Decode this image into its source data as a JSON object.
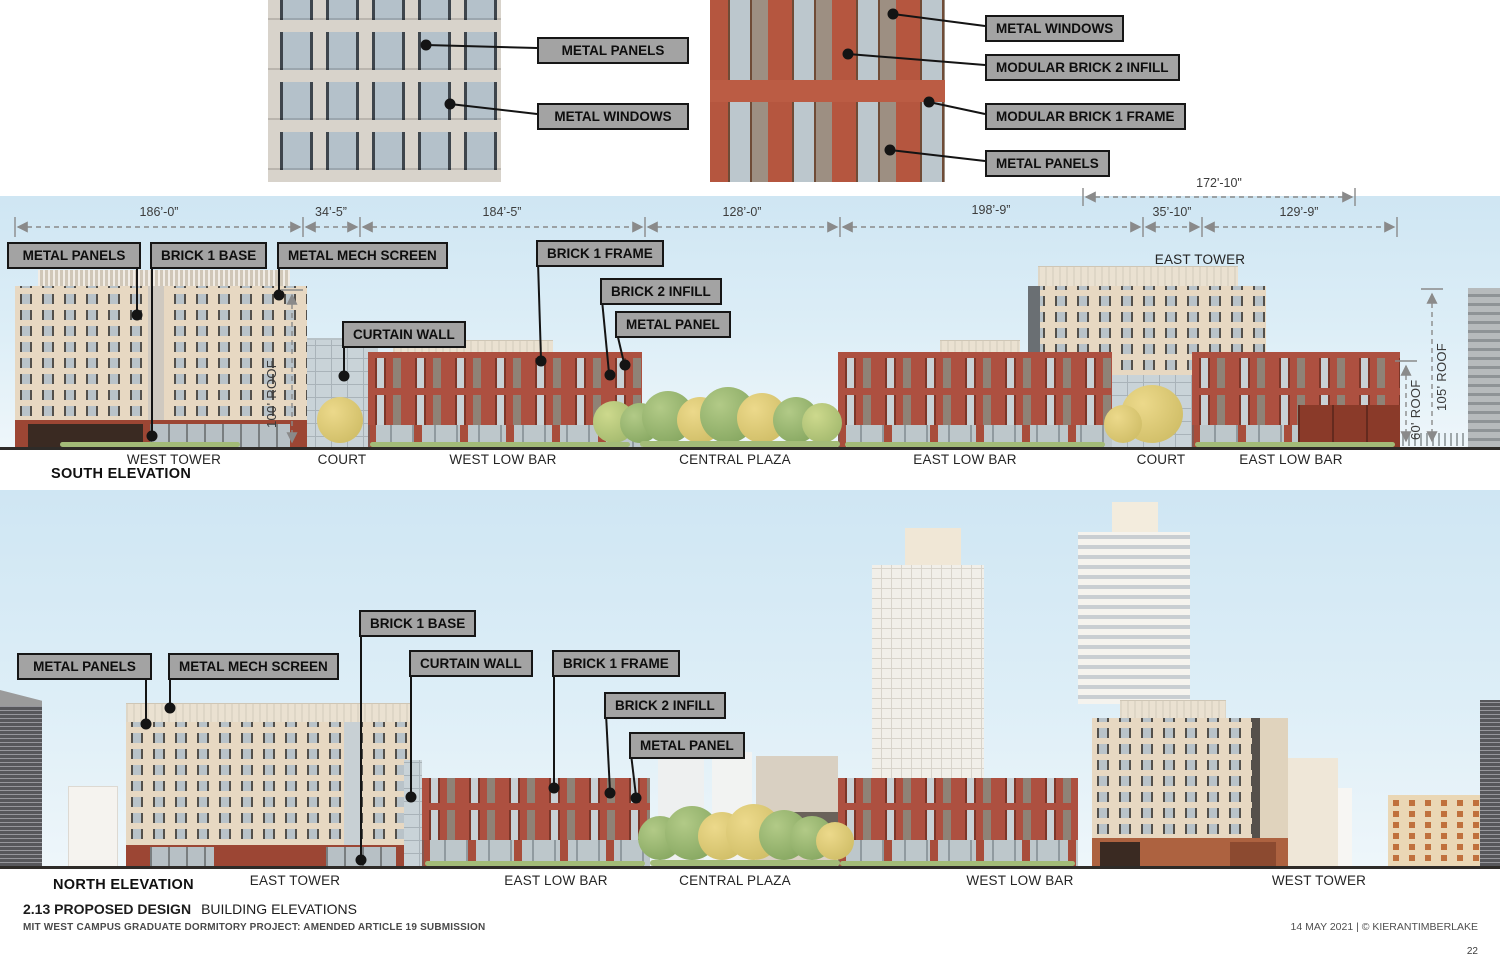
{
  "page": {
    "section_number_title": "2.13 PROPOSED DESIGN",
    "page_title": "BUILDING ELEVATIONS",
    "project_line": "MIT WEST CAMPUS GRADUATE DORMITORY PROJECT: AMENDED ARTICLE 19 SUBMISSION",
    "date_credit": "14 MAY 2021 | © KIERANTIMBERLAKE",
    "page_number": "22"
  },
  "detail_left": {
    "callouts": [
      "METAL PANELS",
      "METAL WINDOWS"
    ]
  },
  "detail_right": {
    "callouts": [
      "METAL WINDOWS",
      "MODULAR BRICK 2 INFILL",
      "MODULAR BRICK 1 FRAME",
      "METAL PANELS"
    ]
  },
  "south_elevation": {
    "title": "SOUTH ELEVATION",
    "overall_dimension": "172'-10\"",
    "dimensions": [
      "186’-0”",
      "34’-5”",
      "184’-5”",
      "128’-0”",
      "198’-9”",
      "35’-10”",
      "129’-9”"
    ],
    "callouts": [
      "METAL PANELS",
      "BRICK 1 BASE",
      "METAL MECH SCREEN",
      "CURTAIN WALL",
      "BRICK 1 FRAME",
      "BRICK 2 INFILL",
      "METAL PANEL"
    ],
    "building_label": "EAST TOWER",
    "roof_dims": [
      "100' ROOF",
      "60' ROOF",
      "105' ROOF"
    ],
    "section_labels": [
      "WEST TOWER",
      "COURT",
      "WEST LOW BAR",
      "CENTRAL PLAZA",
      "EAST LOW BAR",
      "COURT",
      "EAST LOW BAR"
    ]
  },
  "north_elevation": {
    "title": "NORTH ELEVATION",
    "callouts": [
      "METAL PANELS",
      "METAL MECH SCREEN",
      "BRICK 1 BASE",
      "CURTAIN WALL",
      "BRICK 1 FRAME",
      "BRICK 2 INFILL",
      "METAL PANEL"
    ],
    "section_labels": [
      "EAST TOWER",
      "EAST LOW BAR",
      "CENTRAL PLAZA",
      "WEST LOW BAR",
      "WEST TOWER"
    ]
  },
  "colors": {
    "sky_top": "#cfe6f3",
    "sky_bottom": "#eef6fa",
    "callout_bg": "#a3a3a3",
    "callout_border": "#161616",
    "cream_facade": "#e7d8c2",
    "cream_roof": "#eae1d1",
    "brick_red": "#ad5040",
    "brick_frame": "#7c3628",
    "brick_base": "#9c4634",
    "glass": "#c9d3d8",
    "infill_gray": "#8f8276",
    "ground_line": "#2e2b28",
    "dim_line": "#8a8a8a",
    "leader_line": "#141414",
    "text_dark": "#242424"
  }
}
